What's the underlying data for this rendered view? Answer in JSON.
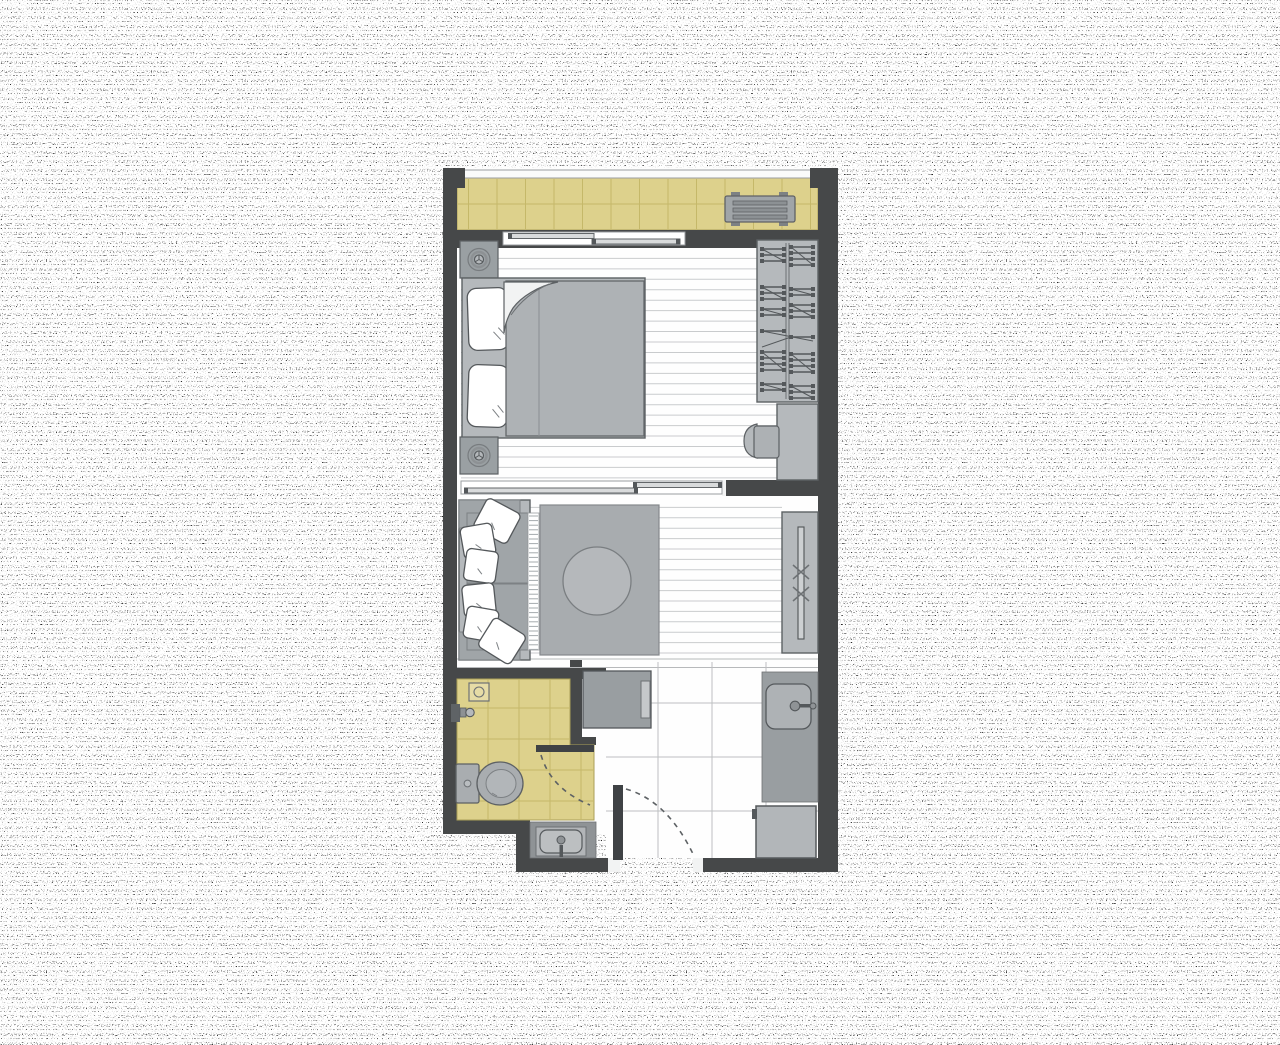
{
  "title": "Apartment floor plan",
  "colors": {
    "wall": "#464849",
    "ink": "#54585b",
    "floor": "#fefefe",
    "plankLine": "#c9cbcd",
    "tileYellow": "#ddd18c",
    "tileGrid": "#c5b869",
    "tileBorder": "#ab9f58",
    "entryGrid": "#bdbfc1",
    "furnLight": "#b5b9bc",
    "furnMid": "#9aa0a3",
    "furnSeat": "#a0a5a8",
    "outline": "#5d6164",
    "rug": "#a8acaf",
    "tableTop": "#b5b8bb",
    "blanket": "#aeb2b5",
    "applianceDark": "#3f4245",
    "noiseDot": "#000000"
  },
  "plan": {
    "rooms": [
      {
        "name": "balcony",
        "features": [
          "tiled-floor",
          "glass-railing",
          "ac-unit"
        ]
      },
      {
        "name": "bedroom",
        "features": [
          "sliding-window",
          "double-bed",
          "pillows",
          "nightstand-top",
          "nightstand-bottom",
          "table-lamps",
          "wardrobe-with-hangers",
          "desk",
          "chair",
          "plank-floor"
        ]
      },
      {
        "name": "living-area",
        "features": [
          "sliding-partition",
          "sofa",
          "throw-pillows",
          "rug",
          "round-coffee-table",
          "tv-console",
          "tv",
          "plank-floor",
          "floor-step"
        ]
      },
      {
        "name": "bathroom",
        "features": [
          "tiled-floor",
          "floor-drain",
          "shower-head",
          "toilet",
          "vanity-sink",
          "open-door-with-swing"
        ]
      },
      {
        "name": "entry",
        "features": [
          "tiled-floor",
          "closet",
          "counter-with-sink",
          "fridge",
          "entry-door-with-swing"
        ]
      }
    ]
  }
}
